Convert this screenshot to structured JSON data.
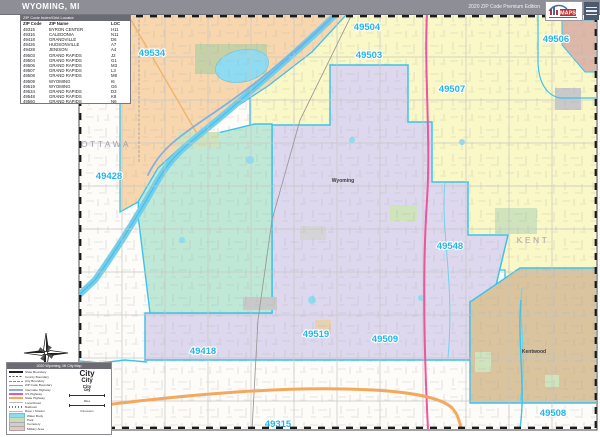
{
  "header": {
    "title": "WYOMING, MI",
    "edition": "2020 ZIP Code Premium Edition",
    "logo": {
      "brand": "MAPS"
    }
  },
  "zip_table": {
    "title": "ZIP Code Index/Grid Locator",
    "columns": [
      "ZIP Code",
      "ZIP Name",
      "LOC"
    ],
    "rows": [
      [
        "49315",
        "BYRON CENTER",
        "H11"
      ],
      [
        "49316",
        "CALEDONIA",
        "N11"
      ],
      [
        "49418",
        "GRANDVILLE",
        "D6"
      ],
      [
        "49426",
        "HUDSONVILLE",
        "A7"
      ],
      [
        "49428",
        "JENISON",
        "A4"
      ],
      [
        "49503",
        "GRAND RAPIDS",
        "J2"
      ],
      [
        "49504",
        "GRAND RAPIDS",
        "G1"
      ],
      [
        "49506",
        "GRAND RAPIDS",
        "M3"
      ],
      [
        "49507",
        "GRAND RAPIDS",
        "L3"
      ],
      [
        "49508",
        "GRAND RAPIDS",
        "M8"
      ],
      [
        "49509",
        "WYOMING",
        "I6"
      ],
      [
        "49519",
        "WYOMING",
        "G6"
      ],
      [
        "49534",
        "GRAND RAPIDS",
        "D3"
      ],
      [
        "49548",
        "GRAND RAPIDS",
        "K8"
      ],
      [
        "49560",
        "GRAND RAPIDS",
        "N6"
      ]
    ]
  },
  "map": {
    "zip_labels": [
      {
        "code": "49534",
        "x": 152,
        "y": 56
      },
      {
        "code": "49504",
        "x": 367,
        "y": 30
      },
      {
        "code": "49503",
        "x": 369,
        "y": 58
      },
      {
        "code": "49506",
        "x": 556,
        "y": 42
      },
      {
        "code": "49507",
        "x": 452,
        "y": 92
      },
      {
        "code": "49428",
        "x": 109,
        "y": 179
      },
      {
        "code": "49548",
        "x": 450,
        "y": 249
      },
      {
        "code": "49519",
        "x": 316,
        "y": 337
      },
      {
        "code": "49509",
        "x": 385,
        "y": 342
      },
      {
        "code": "49418",
        "x": 203,
        "y": 354
      },
      {
        "code": "49315",
        "x": 278,
        "y": 427
      },
      {
        "code": "49508",
        "x": 553,
        "y": 416
      }
    ],
    "county_labels": [
      {
        "name": "OTTAWA",
        "x": 106,
        "y": 147
      },
      {
        "name": "KENT",
        "x": 533,
        "y": 243
      }
    ],
    "city_labels": [
      {
        "name": "Wyoming",
        "x": 343,
        "y": 182
      },
      {
        "name": "Kentwood",
        "x": 534,
        "y": 353
      }
    ],
    "colors": {
      "walker_49534": "#f8d7ae",
      "grand_rapids": "#faf8c6",
      "wyoming_city": "#ded8ef",
      "grandville": "#bfe9d6",
      "kentwood": "#d9c49e",
      "east_gr": "#ddb8a8",
      "water": "#8edcf2",
      "zip_boundary": "#3ac3ed",
      "zip_label": "#25b5e8",
      "interstate": "#7fb2e2",
      "us_highway": "#f0549c",
      "state_highway": "#f2a95f"
    }
  },
  "legend": {
    "title": "2020 Wyoming, MI City Map",
    "items": [
      {
        "type": "state",
        "label": "State Boundary"
      },
      {
        "type": "county",
        "label": "County Boundary"
      },
      {
        "type": "city",
        "label": "City Boundary"
      },
      {
        "type": "zip",
        "label": "ZIP Code Boundary"
      },
      {
        "type": "int",
        "label": "Interstate Highway"
      },
      {
        "type": "us",
        "label": "US Highway"
      },
      {
        "type": "st",
        "label": "State Highway"
      },
      {
        "type": "rd",
        "label": "Local Road"
      },
      {
        "type": "rail",
        "label": "Railroad"
      },
      {
        "type": "stream",
        "label": "River / Stream"
      },
      {
        "type": "water",
        "label": "Water Body"
      },
      {
        "type": "park",
        "label": "Park"
      },
      {
        "type": "cem",
        "label": "Cemetery"
      },
      {
        "type": "mil",
        "label": "Military Area"
      }
    ],
    "place_samples": [
      {
        "text": "City",
        "size": 8
      },
      {
        "text": "City",
        "size": 6
      },
      {
        "text": "City",
        "size": 4.5
      },
      {
        "text": "City",
        "size": 3.5
      }
    ],
    "scale_labels": [
      "Miles",
      "Kilometers"
    ]
  }
}
